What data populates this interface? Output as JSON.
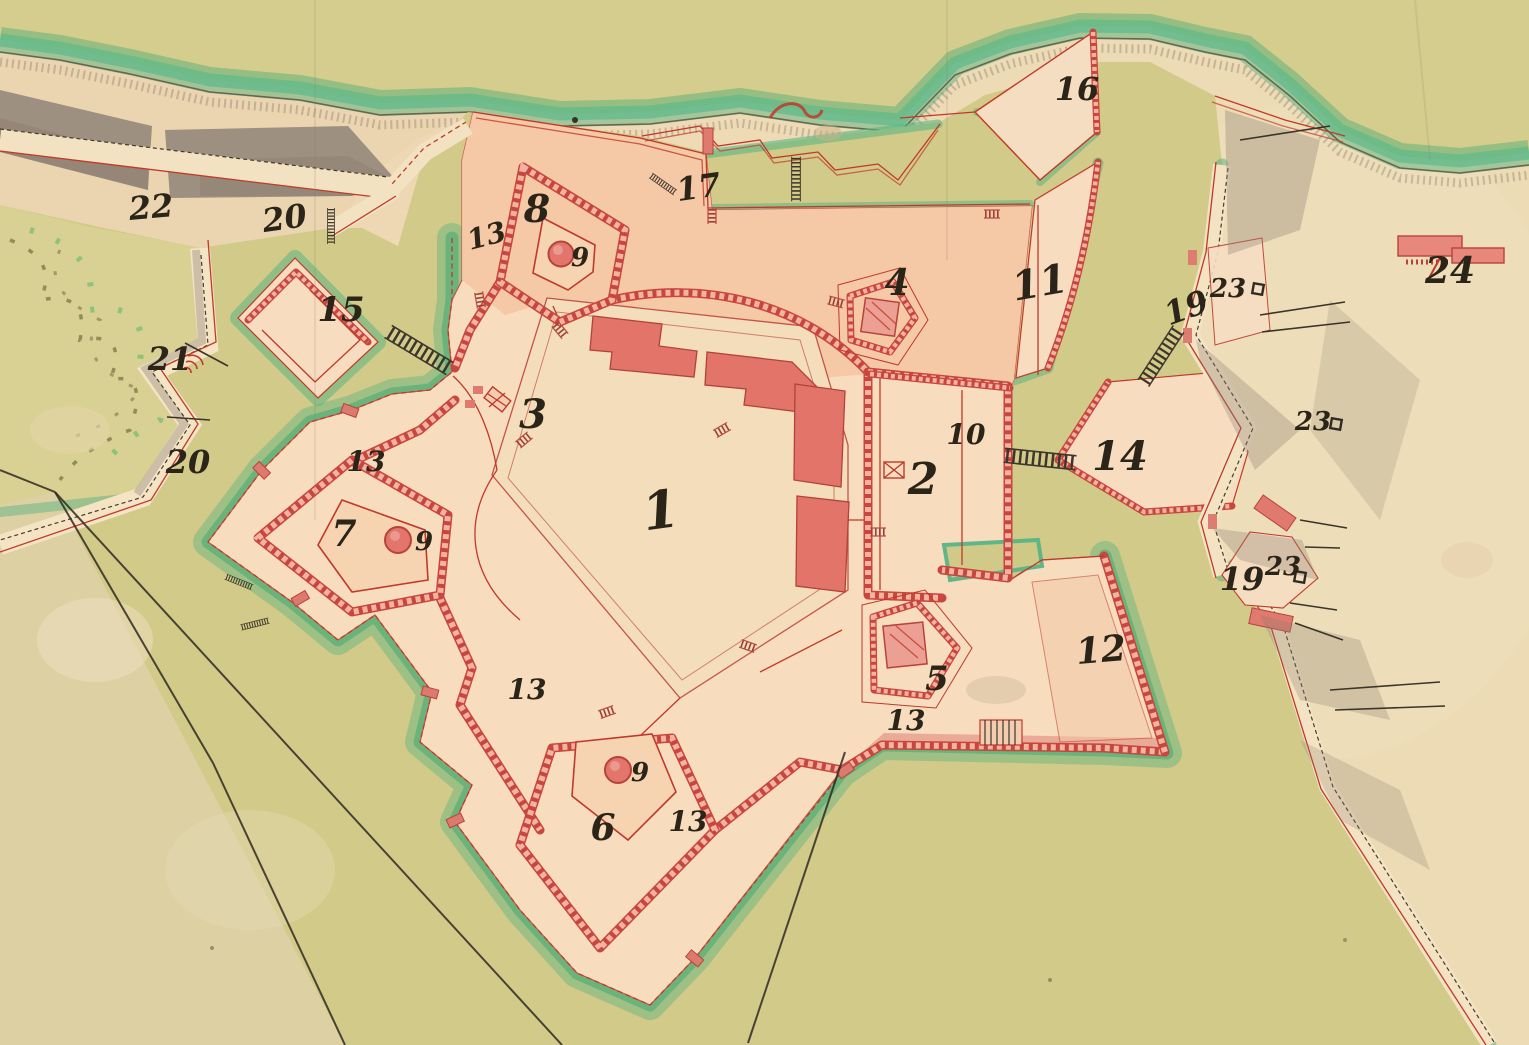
{
  "map": {
    "labels": [
      {
        "t": "1",
        "x": 663,
        "y": 528,
        "s": 52,
        "r": -8
      },
      {
        "t": "2",
        "x": 923,
        "y": 494,
        "s": 44,
        "r": 0
      },
      {
        "t": "3",
        "x": 533,
        "y": 428,
        "s": 40,
        "r": 0
      },
      {
        "t": "4",
        "x": 897,
        "y": 295,
        "s": 36,
        "r": 0
      },
      {
        "t": "5",
        "x": 937,
        "y": 690,
        "s": 34,
        "r": 0
      },
      {
        "t": "6",
        "x": 603,
        "y": 840,
        "s": 36,
        "r": 0
      },
      {
        "t": "7",
        "x": 344,
        "y": 546,
        "s": 36,
        "r": 0
      },
      {
        "t": "8",
        "x": 537,
        "y": 222,
        "s": 38,
        "r": 0
      },
      {
        "t": "9",
        "x": 580,
        "y": 266,
        "s": 26,
        "r": 0
      },
      {
        "t": "9",
        "x": 424,
        "y": 550,
        "s": 26,
        "r": 0
      },
      {
        "t": "9",
        "x": 640,
        "y": 781,
        "s": 26,
        "r": 0
      },
      {
        "t": "10",
        "x": 966,
        "y": 444,
        "s": 28,
        "r": 0
      },
      {
        "t": "11",
        "x": 1042,
        "y": 296,
        "s": 40,
        "r": -10
      },
      {
        "t": "12",
        "x": 1102,
        "y": 662,
        "s": 36,
        "r": -5
      },
      {
        "t": "13",
        "x": 489,
        "y": 245,
        "s": 28,
        "r": -15
      },
      {
        "t": "13",
        "x": 366,
        "y": 471,
        "s": 28,
        "r": 0
      },
      {
        "t": "13",
        "x": 527,
        "y": 699,
        "s": 28,
        "r": 0
      },
      {
        "t": "13",
        "x": 688,
        "y": 831,
        "s": 28,
        "r": 0
      },
      {
        "t": "13",
        "x": 906,
        "y": 730,
        "s": 28,
        "r": 0
      },
      {
        "t": "14",
        "x": 1120,
        "y": 470,
        "s": 40,
        "r": 0
      },
      {
        "t": "15",
        "x": 341,
        "y": 321,
        "s": 34,
        "r": 0
      },
      {
        "t": "16",
        "x": 1077,
        "y": 100,
        "s": 32,
        "r": 0
      },
      {
        "t": "17",
        "x": 700,
        "y": 198,
        "s": 32,
        "r": -8
      },
      {
        "t": "19",
        "x": 1190,
        "y": 318,
        "s": 32,
        "r": -20
      },
      {
        "t": "19",
        "x": 1242,
        "y": 590,
        "s": 32,
        "r": 0
      },
      {
        "t": "20",
        "x": 286,
        "y": 229,
        "s": 32,
        "r": -8
      },
      {
        "t": "20",
        "x": 188,
        "y": 473,
        "s": 32,
        "r": 0
      },
      {
        "t": "21",
        "x": 170,
        "y": 370,
        "s": 32,
        "r": 0
      },
      {
        "t": "22",
        "x": 152,
        "y": 218,
        "s": 32,
        "r": -5
      },
      {
        "t": "23",
        "x": 1228,
        "y": 297,
        "s": 26,
        "r": 0
      },
      {
        "t": "23",
        "x": 1313,
        "y": 430,
        "s": 26,
        "r": 0
      },
      {
        "t": "23",
        "x": 1283,
        "y": 575,
        "s": 26,
        "r": 0
      },
      {
        "t": "24",
        "x": 1450,
        "y": 283,
        "s": 36,
        "r": 0
      }
    ],
    "magazines": [
      {
        "x": 1258,
        "y": 289
      },
      {
        "x": 1336,
        "y": 424
      },
      {
        "x": 1300,
        "y": 577
      }
    ],
    "colors": {
      "parchment": "#ecdbb4",
      "terrain_olive": "#d2ca88",
      "field_olive": "#d9d094",
      "moat_fringe_green": "#4fb282",
      "fort_body_peach": "#f8dcbe",
      "esplanade_pink": "#f4c5a4",
      "rampart_red": "#c7473f",
      "wall_pink": "#f3b3a0",
      "building_red": "#e2746a",
      "shadow_gray": "#8f8172",
      "ink": "#2f2a22"
    }
  }
}
